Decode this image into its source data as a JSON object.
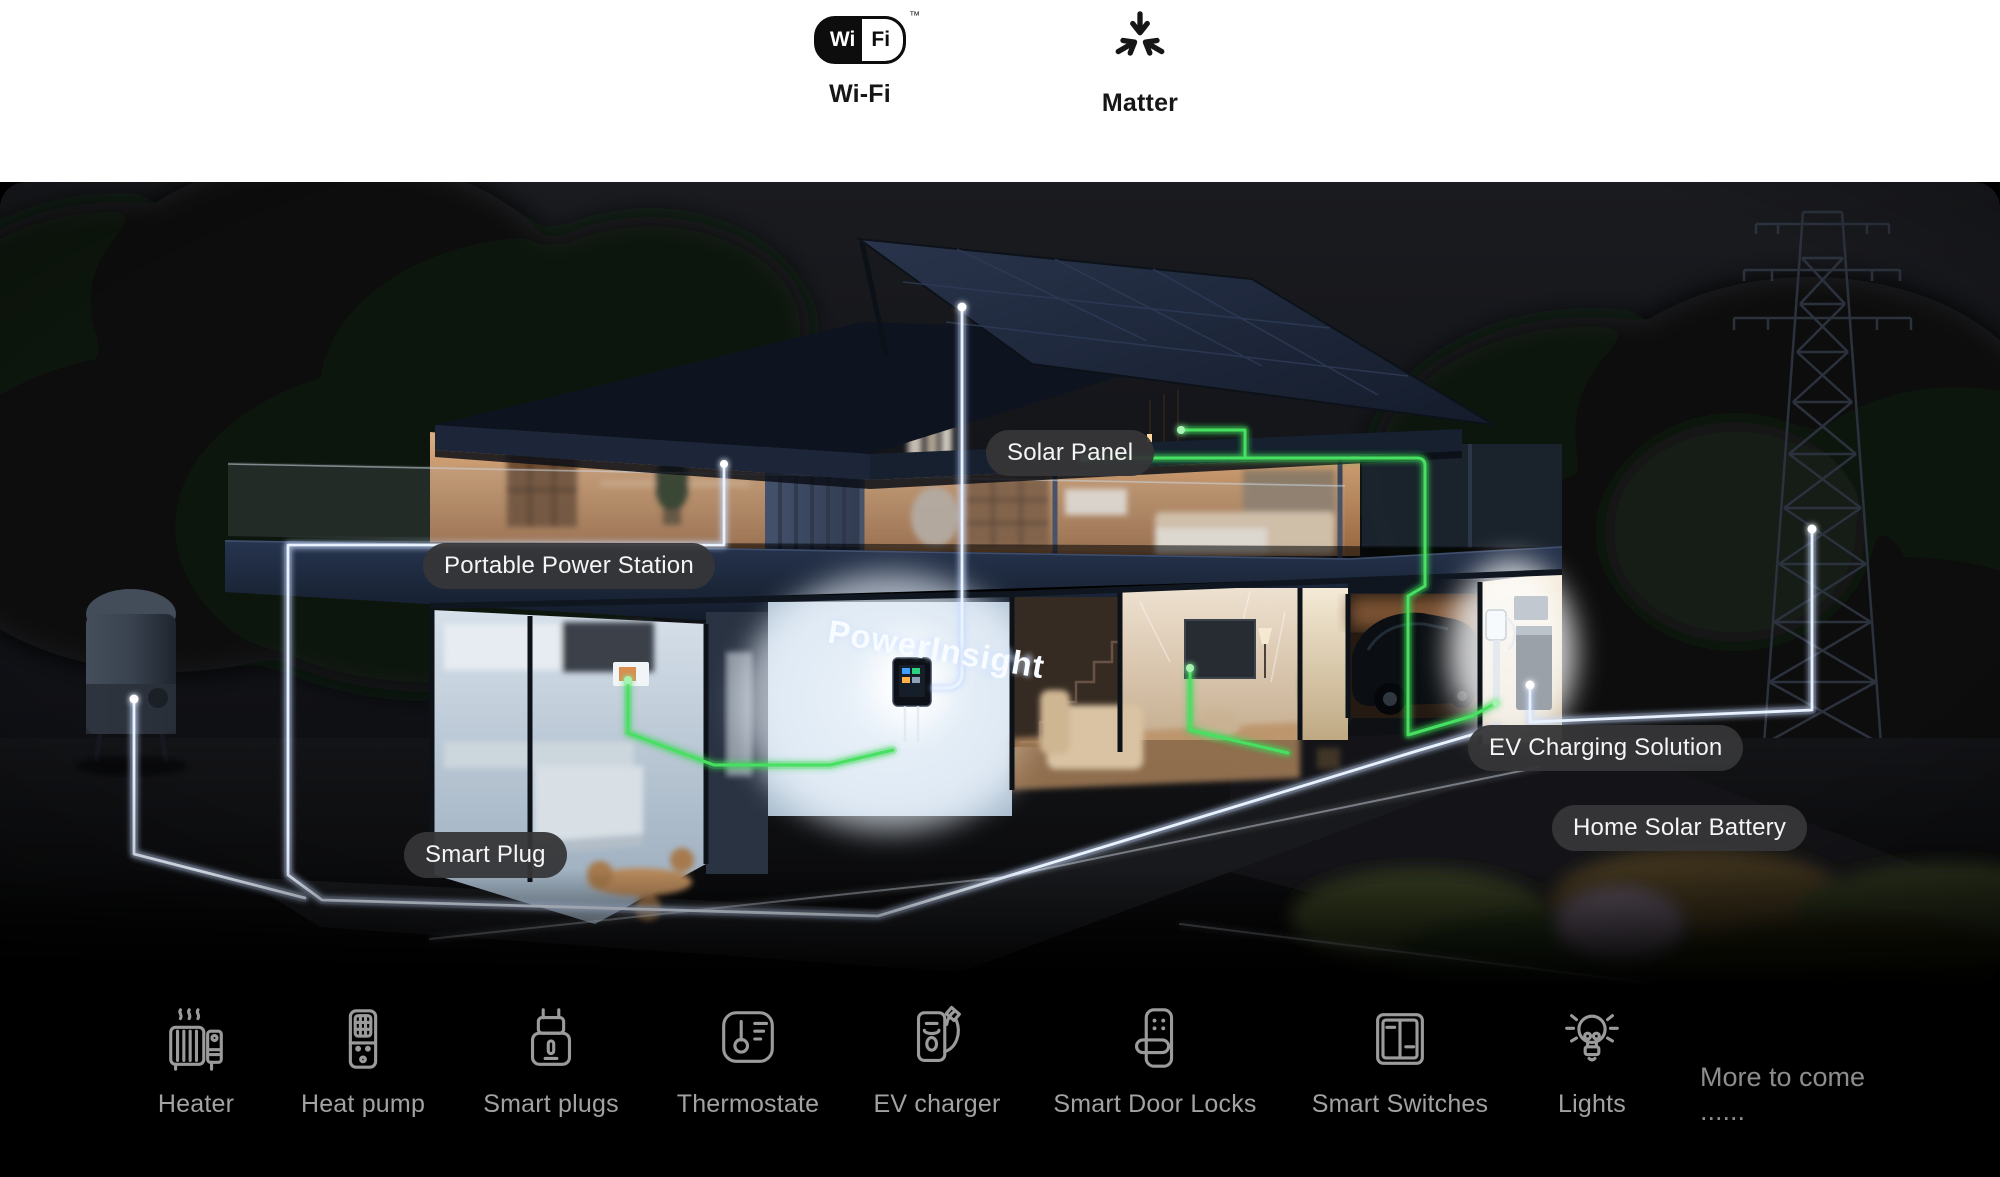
{
  "connectivity_bar": {
    "items": [
      {
        "id": "wifi",
        "label": "Wi-Fi",
        "logo_left": "Wi",
        "logo_right": "Fi",
        "trademark": "™"
      },
      {
        "id": "matter",
        "label": "Matter"
      }
    ]
  },
  "scene": {
    "brand": "PowerInsight",
    "labels": [
      {
        "id": "solar-panel",
        "text": "Solar Panel"
      },
      {
        "id": "portable-power-station",
        "text": "Portable Power Station"
      },
      {
        "id": "smart-plug",
        "text": "Smart Plug"
      },
      {
        "id": "ev-charging-solution",
        "text": "EV Charging Solution"
      },
      {
        "id": "home-solar-battery",
        "text": "Home Solar Battery"
      }
    ],
    "colors": {
      "pill_background": "#39393b",
      "pill_text": "#f5f5f5",
      "wire_white": "#e9f2ff",
      "wire_green": "#47e061"
    }
  },
  "footer": {
    "text_color": "#a2a2a2",
    "items": [
      {
        "id": "heater",
        "label": "Heater"
      },
      {
        "id": "heat-pump",
        "label": "Heat pump"
      },
      {
        "id": "smart-plugs",
        "label": "Smart plugs"
      },
      {
        "id": "thermostate",
        "label": "Thermostate"
      },
      {
        "id": "ev-charger",
        "label": "EV charger"
      },
      {
        "id": "smart-door-locks",
        "label": "Smart Door Locks"
      },
      {
        "id": "smart-switches",
        "label": "Smart Switches"
      },
      {
        "id": "lights",
        "label": "Lights"
      }
    ],
    "more": {
      "line1": "More to come",
      "line2": "......"
    }
  }
}
